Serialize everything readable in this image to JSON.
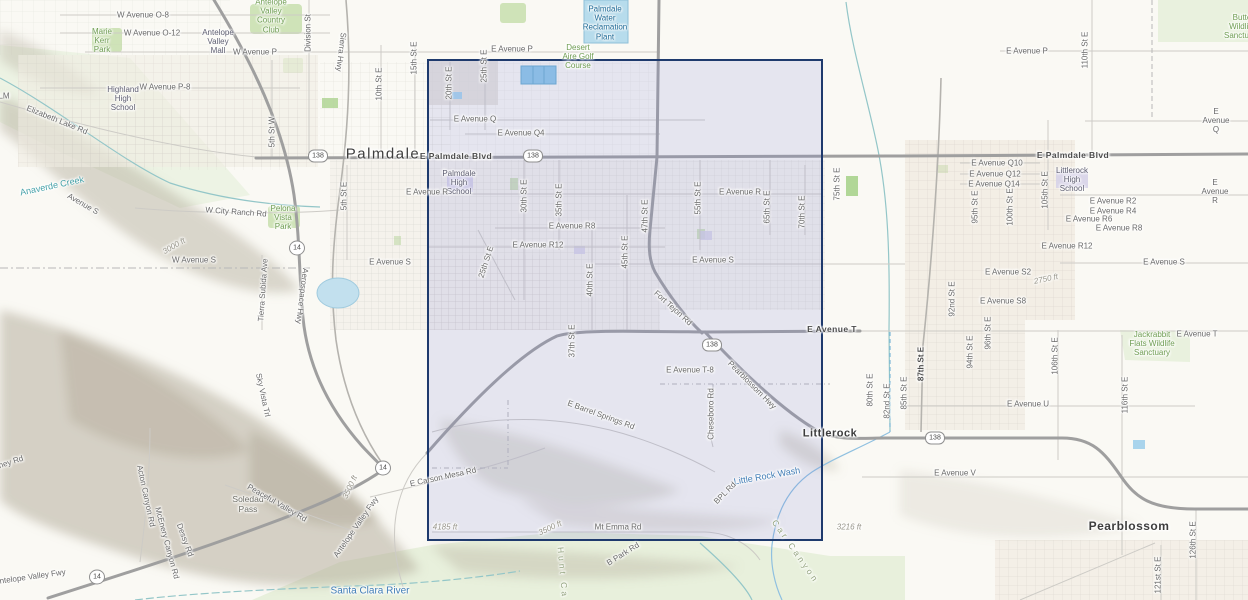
{
  "map": {
    "background": "#faf9f4",
    "selection": {
      "x": 427,
      "y": 59,
      "w": 396,
      "h": 482,
      "fill": "rgba(125,132,215,0.17)",
      "border": "#1e3a6d"
    },
    "shields": [
      {
        "route": "138",
        "x": 318,
        "y": 156
      },
      {
        "route": "138",
        "x": 533,
        "y": 156
      },
      {
        "route": "138",
        "x": 712,
        "y": 345
      },
      {
        "route": "138",
        "x": 935,
        "y": 438
      },
      {
        "route": "14",
        "x": 297,
        "y": 248
      },
      {
        "route": "14",
        "x": 383,
        "y": 468
      },
      {
        "route": "14",
        "x": 97,
        "y": 577
      }
    ],
    "labels": [
      {
        "t": "W Avenue O-8",
        "x": 143,
        "y": 15,
        "c": "road"
      },
      {
        "t": "W Avenue O-12",
        "x": 152,
        "y": 33,
        "c": "road"
      },
      {
        "t": "Antelope\nValley\nCountry\nClub",
        "x": 271,
        "y": 16,
        "c": "green"
      },
      {
        "t": "Marie\nKerr\nPark",
        "x": 102,
        "y": 41,
        "c": "green"
      },
      {
        "t": "Antelope\nValley\nMall",
        "x": 218,
        "y": 42,
        "c": "poi"
      },
      {
        "t": "Division St",
        "x": 308,
        "y": 33,
        "c": "road",
        "r": -90
      },
      {
        "t": "Sierra Hwy",
        "x": 341,
        "y": 52,
        "c": "road",
        "r": 97
      },
      {
        "t": "W Avenue P",
        "x": 255,
        "y": 52,
        "c": "road"
      },
      {
        "t": "E Avenue P",
        "x": 512,
        "y": 49,
        "c": "road"
      },
      {
        "t": "Desert\nAire Golf\nCourse",
        "x": 578,
        "y": 57,
        "c": "green"
      },
      {
        "t": "Palmdale\nWater\nReclamation\nPlant",
        "x": 605,
        "y": 23,
        "c": "plant"
      },
      {
        "t": "E Avenue P",
        "x": 1027,
        "y": 51,
        "c": "road"
      },
      {
        "t": "110th St E",
        "x": 1085,
        "y": 50,
        "c": "road",
        "r": -90
      },
      {
        "t": "Butte\nWildlife\nSanctuary",
        "x": 1242,
        "y": 27,
        "c": "green"
      },
      {
        "t": "E Avenue Q",
        "x": 1216,
        "y": 121,
        "c": "road"
      },
      {
        "t": "15th St E",
        "x": 414,
        "y": 58,
        "c": "road",
        "r": -90
      },
      {
        "t": "10th St E",
        "x": 379,
        "y": 84,
        "c": "road",
        "r": -90
      },
      {
        "t": "20th St E",
        "x": 449,
        "y": 83,
        "c": "road",
        "r": -90
      },
      {
        "t": "25th St E",
        "x": 484,
        "y": 66,
        "c": "road",
        "r": -90
      },
      {
        "t": "5th St W",
        "x": 272,
        "y": 132,
        "c": "road",
        "r": -90
      },
      {
        "t": "W Avenue P-8",
        "x": 165,
        "y": 87,
        "c": "road"
      },
      {
        "t": "Highland\nHigh\nSchool",
        "x": 123,
        "y": 99,
        "c": "poi"
      },
      {
        "t": "Elizabeth Lake Rd",
        "x": 57,
        "y": 120,
        "c": "road",
        "r": 22
      },
      {
        "t": "LM",
        "x": 4,
        "y": 96,
        "c": "road"
      },
      {
        "t": "Palmdale",
        "x": 383,
        "y": 154,
        "c": "city"
      },
      {
        "t": "E Palmdale Blvd",
        "x": 456,
        "y": 157,
        "c": "blvd"
      },
      {
        "t": "E Palmdale Blvd",
        "x": 1073,
        "y": 156,
        "c": "blvd"
      },
      {
        "t": "E Avenue Q",
        "x": 475,
        "y": 119,
        "c": "road"
      },
      {
        "t": "E Avenue Q4",
        "x": 521,
        "y": 133,
        "c": "road"
      },
      {
        "t": "Palmdale\nHigh\nSchool",
        "x": 459,
        "y": 183,
        "c": "poi"
      },
      {
        "t": "E Avenue R",
        "x": 427,
        "y": 192,
        "c": "road"
      },
      {
        "t": "E Avenue R",
        "x": 740,
        "y": 192,
        "c": "road"
      },
      {
        "t": "E Avenue R",
        "x": 1215,
        "y": 192,
        "c": "road"
      },
      {
        "t": "30th St E",
        "x": 524,
        "y": 196,
        "c": "road",
        "r": -90
      },
      {
        "t": "35th St E",
        "x": 559,
        "y": 200,
        "c": "road",
        "r": -90
      },
      {
        "t": "E Avenue R8",
        "x": 572,
        "y": 226,
        "c": "road"
      },
      {
        "t": "E Avenue R12",
        "x": 538,
        "y": 245,
        "c": "road"
      },
      {
        "t": "25th St E",
        "x": 486,
        "y": 262,
        "c": "road",
        "r": -72
      },
      {
        "t": "45th St E",
        "x": 625,
        "y": 252,
        "c": "road",
        "r": -90
      },
      {
        "t": "40th St E",
        "x": 590,
        "y": 280,
        "c": "road",
        "r": -90
      },
      {
        "t": "47th St E",
        "x": 645,
        "y": 216,
        "c": "road",
        "r": -90
      },
      {
        "t": "55th St E",
        "x": 698,
        "y": 198,
        "c": "road",
        "r": -90
      },
      {
        "t": "65th St E",
        "x": 767,
        "y": 207,
        "c": "road",
        "r": -90
      },
      {
        "t": "70th St E",
        "x": 802,
        "y": 212,
        "c": "road",
        "r": -90
      },
      {
        "t": "75th St E",
        "x": 837,
        "y": 184,
        "c": "road",
        "r": -90
      },
      {
        "t": "E Avenue S",
        "x": 713,
        "y": 260,
        "c": "road"
      },
      {
        "t": "E Avenue S",
        "x": 390,
        "y": 262,
        "c": "road"
      },
      {
        "t": "E Avenue S",
        "x": 1164,
        "y": 262,
        "c": "road"
      },
      {
        "t": "W Avenue S",
        "x": 194,
        "y": 260,
        "c": "road"
      },
      {
        "t": "Avenue S",
        "x": 83,
        "y": 204,
        "c": "road",
        "r": 30
      },
      {
        "t": "Anaverde Creek",
        "x": 52,
        "y": 186,
        "c": "teal",
        "r": -12
      },
      {
        "t": "W City Ranch Rd",
        "x": 236,
        "y": 212,
        "c": "road",
        "r": 4
      },
      {
        "t": "Pelona\nVista\nPark",
        "x": 283,
        "y": 218,
        "c": "green"
      },
      {
        "t": "Tierra Subida Ave",
        "x": 263,
        "y": 290,
        "c": "road",
        "r": -86
      },
      {
        "t": "Aerospace Hwy",
        "x": 302,
        "y": 296,
        "c": "road",
        "r": 97
      },
      {
        "t": "5th St E",
        "x": 344,
        "y": 196,
        "c": "road",
        "r": -90
      },
      {
        "t": "3000 ft",
        "x": 174,
        "y": 246,
        "c": "elev",
        "r": -30
      },
      {
        "t": "Fort Tejon Rd",
        "x": 673,
        "y": 308,
        "c": "road",
        "r": 42
      },
      {
        "t": "E Avenue T",
        "x": 832,
        "y": 330,
        "c": "blvd"
      },
      {
        "t": "E Avenue T",
        "x": 1197,
        "y": 334,
        "c": "road"
      },
      {
        "t": "Pearblossom Hwy",
        "x": 752,
        "y": 385,
        "c": "road",
        "r": 45
      },
      {
        "t": "E Avenue T-8",
        "x": 690,
        "y": 370,
        "c": "road"
      },
      {
        "t": "37th St E",
        "x": 572,
        "y": 341,
        "c": "road",
        "r": -90
      },
      {
        "t": "Cheseboro Rd",
        "x": 711,
        "y": 414,
        "c": "road",
        "r": -90
      },
      {
        "t": "E Barrel Springs Rd",
        "x": 601,
        "y": 415,
        "c": "road",
        "r": 20
      },
      {
        "t": "E Carson Mesa Rd",
        "x": 443,
        "y": 477,
        "c": "road",
        "r": -12
      },
      {
        "t": "Littlerock",
        "x": 830,
        "y": 434,
        "c": "town"
      },
      {
        "t": "Little Rock Wash",
        "x": 767,
        "y": 476,
        "c": "blue",
        "r": -10
      },
      {
        "t": "BPL Rd",
        "x": 725,
        "y": 493,
        "c": "road",
        "r": -45
      },
      {
        "t": "Mt Emma Rd",
        "x": 618,
        "y": 527,
        "c": "road"
      },
      {
        "t": "4185 ft",
        "x": 445,
        "y": 527,
        "c": "elev"
      },
      {
        "t": "3500 ft",
        "x": 550,
        "y": 528,
        "c": "elev",
        "r": -25
      },
      {
        "t": "3500 ft",
        "x": 350,
        "y": 487,
        "c": "elev",
        "r": -65
      },
      {
        "t": "Car Canyon",
        "x": 795,
        "y": 552,
        "c": "canyon",
        "r": 55
      },
      {
        "t": "Hunt Ca",
        "x": 562,
        "y": 573,
        "c": "canyon",
        "r": 85
      },
      {
        "t": "B Park Rd",
        "x": 623,
        "y": 554,
        "c": "road",
        "r": -32
      },
      {
        "t": "Santa Clara River",
        "x": 370,
        "y": 591,
        "c": "blue",
        "s": 10
      },
      {
        "t": "Soledad\nPass",
        "x": 248,
        "y": 505,
        "c": "poi2"
      },
      {
        "t": "Antelope Valley Fwy",
        "x": 356,
        "y": 527,
        "c": "road",
        "r": -55
      },
      {
        "t": "Antelope Valley Fwy",
        "x": 30,
        "y": 577,
        "c": "road",
        "r": -8
      },
      {
        "t": "Acton Canyon Rd",
        "x": 146,
        "y": 496,
        "c": "road",
        "r": 78
      },
      {
        "t": "McEnery Canyon Rd",
        "x": 167,
        "y": 543,
        "c": "road",
        "r": 75
      },
      {
        "t": "Dessy Rd",
        "x": 185,
        "y": 540,
        "c": "road",
        "r": 70
      },
      {
        "t": "Peaceful Valley Rd",
        "x": 277,
        "y": 503,
        "c": "road",
        "r": 30
      },
      {
        "t": "Sky Vista Trl",
        "x": 263,
        "y": 395,
        "c": "road",
        "r": 78
      },
      {
        "t": "ney Rd",
        "x": 11,
        "y": 462,
        "c": "road",
        "r": -18
      },
      {
        "t": "E Avenue Q10",
        "x": 997,
        "y": 163,
        "c": "road"
      },
      {
        "t": "E Avenue Q12",
        "x": 995,
        "y": 174,
        "c": "road"
      },
      {
        "t": "E Avenue Q14",
        "x": 994,
        "y": 184,
        "c": "road"
      },
      {
        "t": "Littlerock\nHigh\nSchool",
        "x": 1072,
        "y": 180,
        "c": "poi"
      },
      {
        "t": "E Avenue R2",
        "x": 1113,
        "y": 201,
        "c": "road"
      },
      {
        "t": "E Avenue R4",
        "x": 1113,
        "y": 211,
        "c": "road"
      },
      {
        "t": "E Avenue R6",
        "x": 1089,
        "y": 219,
        "c": "road"
      },
      {
        "t": "E Avenue R8",
        "x": 1119,
        "y": 228,
        "c": "road"
      },
      {
        "t": "E Avenue R12",
        "x": 1067,
        "y": 246,
        "c": "road"
      },
      {
        "t": "95th St E",
        "x": 975,
        "y": 207,
        "c": "road",
        "r": -90
      },
      {
        "t": "100th St E",
        "x": 1010,
        "y": 207,
        "c": "road",
        "r": -90
      },
      {
        "t": "105th St E",
        "x": 1045,
        "y": 190,
        "c": "road",
        "r": -90
      },
      {
        "t": "E Avenue S2",
        "x": 1008,
        "y": 272,
        "c": "road"
      },
      {
        "t": "2750 ft",
        "x": 1046,
        "y": 279,
        "c": "elev",
        "r": -12
      },
      {
        "t": "E Avenue S8",
        "x": 1003,
        "y": 301,
        "c": "road"
      },
      {
        "t": "92nd St E",
        "x": 952,
        "y": 299,
        "c": "road",
        "r": -90
      },
      {
        "t": "87th St E",
        "x": 921,
        "y": 364,
        "c": "roadb",
        "r": -90
      },
      {
        "t": "85th St E",
        "x": 904,
        "y": 393,
        "c": "road",
        "r": -90
      },
      {
        "t": "80th St E",
        "x": 870,
        "y": 390,
        "c": "road",
        "r": -90
      },
      {
        "t": "82nd St E",
        "x": 887,
        "y": 401,
        "c": "road",
        "r": -90
      },
      {
        "t": "94th St E",
        "x": 970,
        "y": 352,
        "c": "road",
        "r": -90
      },
      {
        "t": "96th St E",
        "x": 988,
        "y": 333,
        "c": "road",
        "r": -90
      },
      {
        "t": "106th St E",
        "x": 1055,
        "y": 356,
        "c": "road",
        "r": -90
      },
      {
        "t": "116th St E",
        "x": 1125,
        "y": 395,
        "c": "road",
        "r": -90
      },
      {
        "t": "E Avenue U",
        "x": 1028,
        "y": 404,
        "c": "road"
      },
      {
        "t": "E Avenue V",
        "x": 955,
        "y": 473,
        "c": "road"
      },
      {
        "t": "Jackrabbit\nFlats Wildlife\nSanctuary",
        "x": 1152,
        "y": 344,
        "c": "green"
      },
      {
        "t": "3216 ft",
        "x": 849,
        "y": 527,
        "c": "elev"
      },
      {
        "t": "Pearblossom",
        "x": 1129,
        "y": 527,
        "c": "town",
        "s": 12
      },
      {
        "t": "126th St E",
        "x": 1193,
        "y": 540,
        "c": "road",
        "r": -90
      },
      {
        "t": "121st St E",
        "x": 1158,
        "y": 575,
        "c": "road",
        "r": -90
      }
    ]
  }
}
